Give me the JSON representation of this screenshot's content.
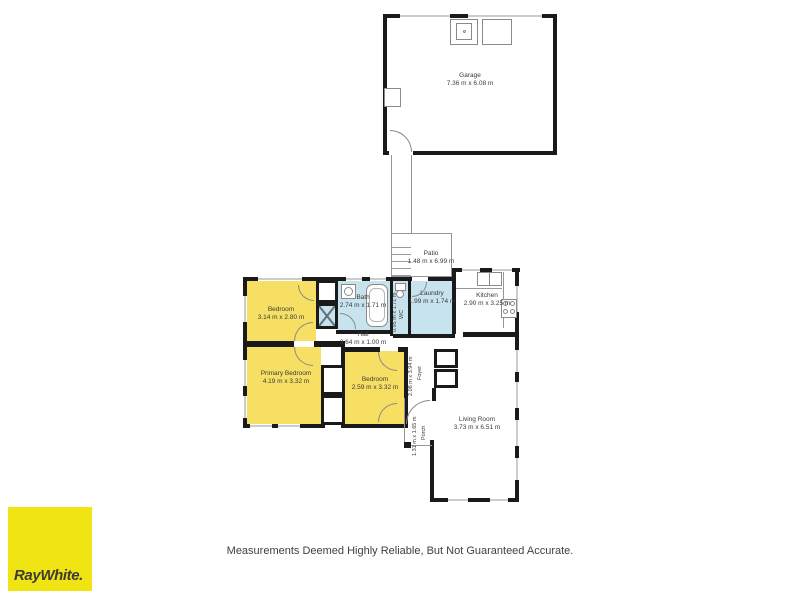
{
  "brand": {
    "logo_text": "RayWhite.",
    "logo_bg": "#f0e413",
    "logo_text_color": "#3c3c34"
  },
  "disclaimer": "Measurements Deemed Highly Reliable, But Not Guaranteed Accurate.",
  "colors": {
    "bedroom_fill": "#f6df63",
    "wet_area_fill": "#c6e3ee",
    "wall": "#1a1a1a"
  },
  "rooms": {
    "garage": {
      "name": "Garage",
      "dims": "7.36 m x 6.08 m"
    },
    "patio": {
      "name": "Patio",
      "dims": "1.48 m x 6.99 m"
    },
    "bedroom1": {
      "name": "Bedroom",
      "dims": "3.14 m x 2.80 m"
    },
    "bath": {
      "name": "Bath",
      "dims": "2.74 m x 1.71 m"
    },
    "wc": {
      "name": "WC",
      "dims": "0.95 m x 1.71 m"
    },
    "laundry": {
      "name": "Laundry",
      "dims": "1.99 m x 1.74 m"
    },
    "kitchen": {
      "name": "Kitchen",
      "dims": "2.90 m x 3.25 m"
    },
    "hall": {
      "name": "Hall",
      "dims": "3.64 m x 1.00 m"
    },
    "primary_bedroom": {
      "name": "Primary Bedroom",
      "dims": "4.19 m x 3.32 m"
    },
    "bedroom2": {
      "name": "Bedroom",
      "dims": "2.59 m x 3.32 m"
    },
    "foyer": {
      "name": "Foyer",
      "dims": "2.08 m x 3.94 m"
    },
    "porch": {
      "name": "Porch",
      "dims": "1.31 m x 1.65 m"
    },
    "living_room": {
      "name": "Living Room",
      "dims": "3.73 m x 6.51 m"
    }
  }
}
